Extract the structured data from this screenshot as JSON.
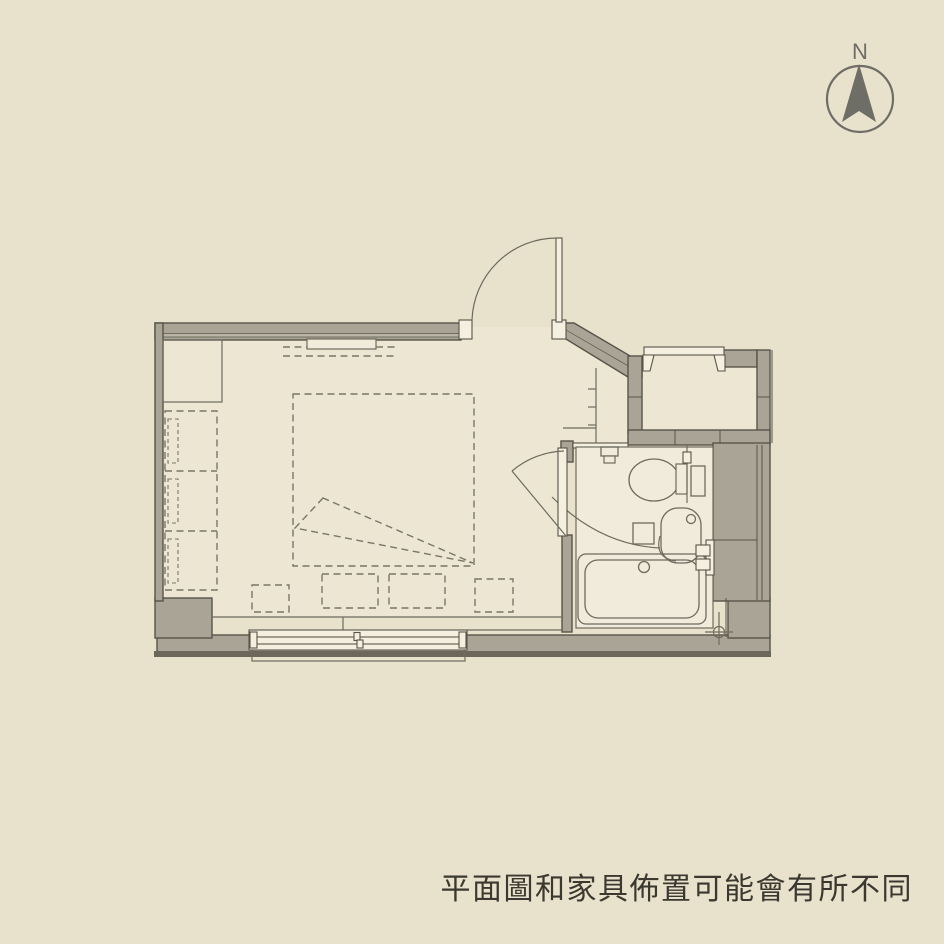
{
  "page": {
    "background": "#e8e1cc"
  },
  "compass": {
    "label": "N"
  },
  "caption": {
    "text": "平面圖和家具佈置可能會有所不同"
  },
  "colors": {
    "background": "#e8e1cc",
    "room_fill": "#ece6d3",
    "bath_fill": "#f0ebdb",
    "wall_fill": "#a9a496",
    "wall_light": "#b9b4a3",
    "wall_dark": "#57544a",
    "dark_edge": "#6b675a",
    "line": "#6e6b5f",
    "dash": "#7a7668",
    "compass": "#6e6d66",
    "text": "#3a382f",
    "white": "#f4efdf"
  },
  "floorplan": {
    "label": "studio-apartment-floor-plan",
    "features": [
      "north-arrow-icon",
      "entry-door",
      "bathroom-door",
      "toilet",
      "washbasin",
      "bathtub",
      "bath-faucet",
      "floor-drain",
      "sliding-window",
      "small-window",
      "bed",
      "blanket-fold",
      "wardrobe",
      "closet",
      "hanger-rod",
      "floor-cushions",
      "balcony-wall",
      "service-shaft"
    ]
  }
}
